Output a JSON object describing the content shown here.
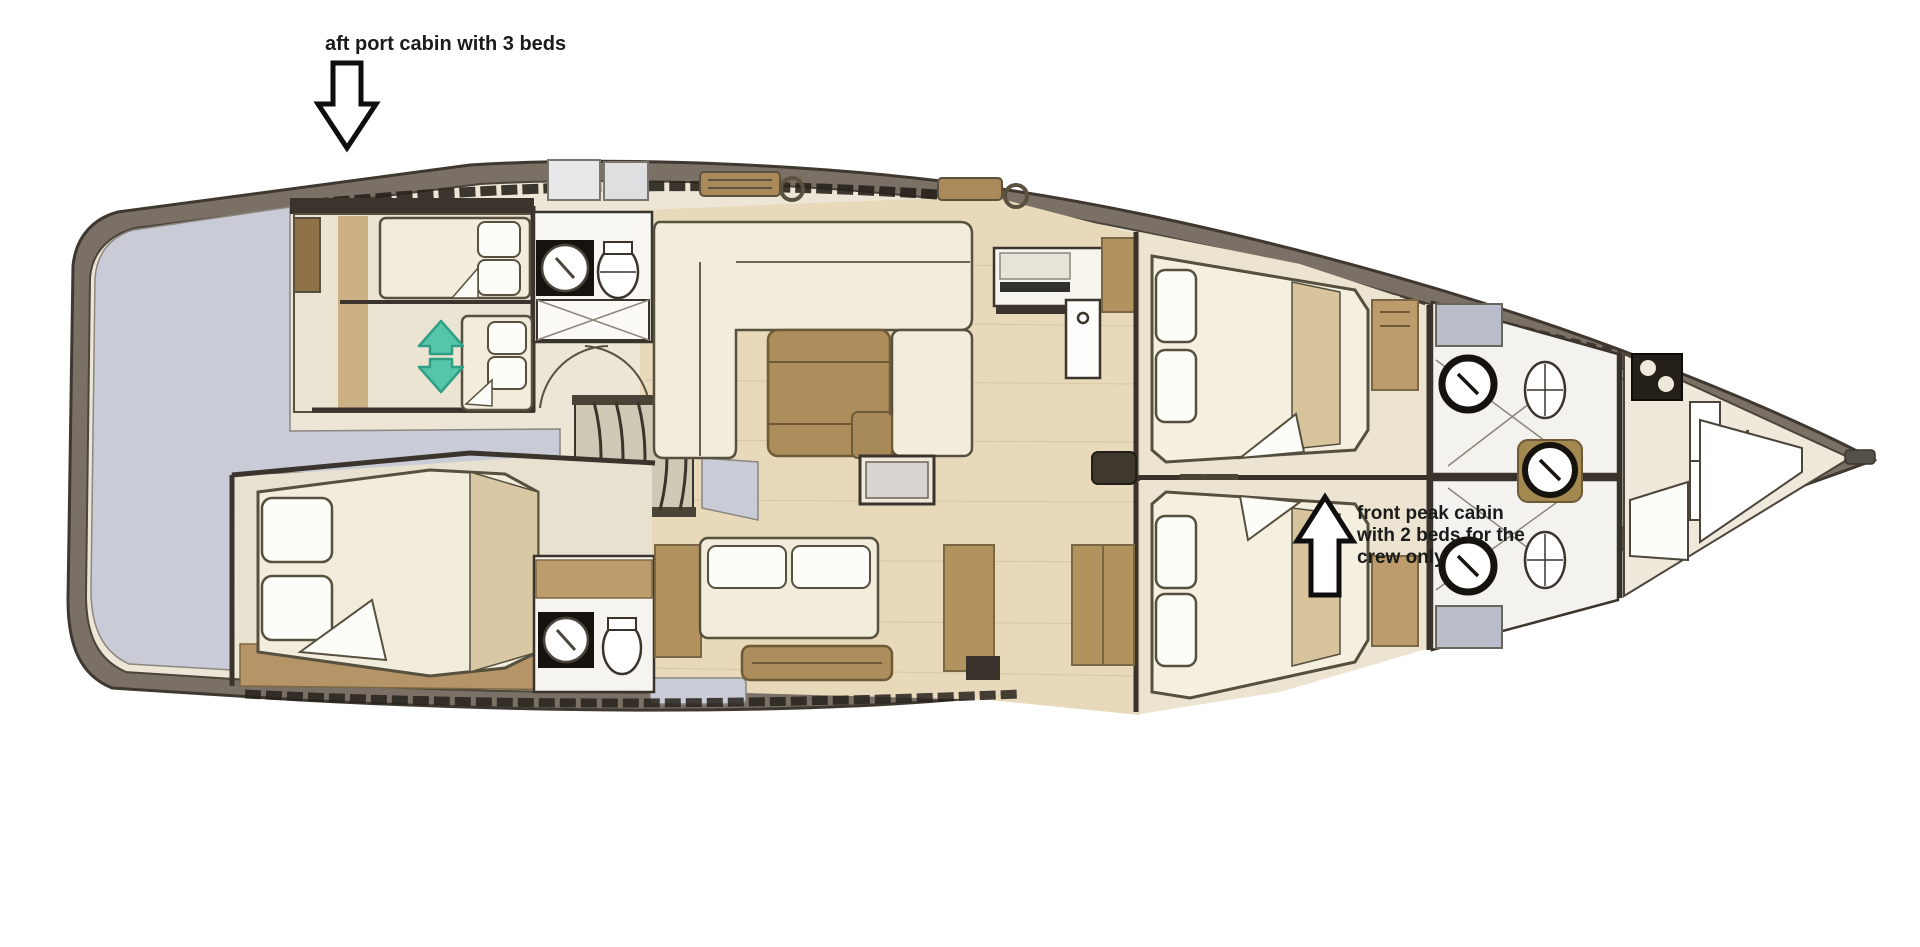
{
  "figure": {
    "type": "yacht interior floor plan, top view, bow pointing right",
    "annotations": {
      "aft_cabin": {
        "text": "aft port cabin with 3 beds",
        "arrow_direction": "down",
        "arrow_style": "hollow outline arrow"
      },
      "crew_cabin": {
        "lines": [
          "front peak cabin",
          "with 2 beds for the",
          "crew only"
        ],
        "arrow_direction": "up",
        "arrow_style": "hollow outline arrow"
      }
    },
    "palette": {
      "background": "#FFFFFF",
      "hull_band": "#7B7065",
      "hull_outline": "#3E3831",
      "wall_dark": "#3A342C",
      "stern_platform_gray": "#C9CCD6",
      "floor_cream": "#EDE6D6",
      "floor_wood": "#E7D9BA",
      "furniture_cream": "#F2ECDC",
      "linen_white": "#FCFCF8",
      "wood_tan_dark": "#A98A58",
      "wood_tan_mid": "#B2935F",
      "wood_tan_light": "#D8C49C",
      "fixture_black": "#16130F",
      "locker_gray": "#B9BDC9",
      "accent_teal": "#56C6AB",
      "annotation_text": "#1B1B1B"
    },
    "icons": [
      "down-arrow-icon",
      "up-arrow-icon",
      "sliding-bed-double-arrow-icon",
      "sink-icon",
      "toilet-icon",
      "shower-icon",
      "stairs-icon",
      "windlass-icon"
    ]
  }
}
